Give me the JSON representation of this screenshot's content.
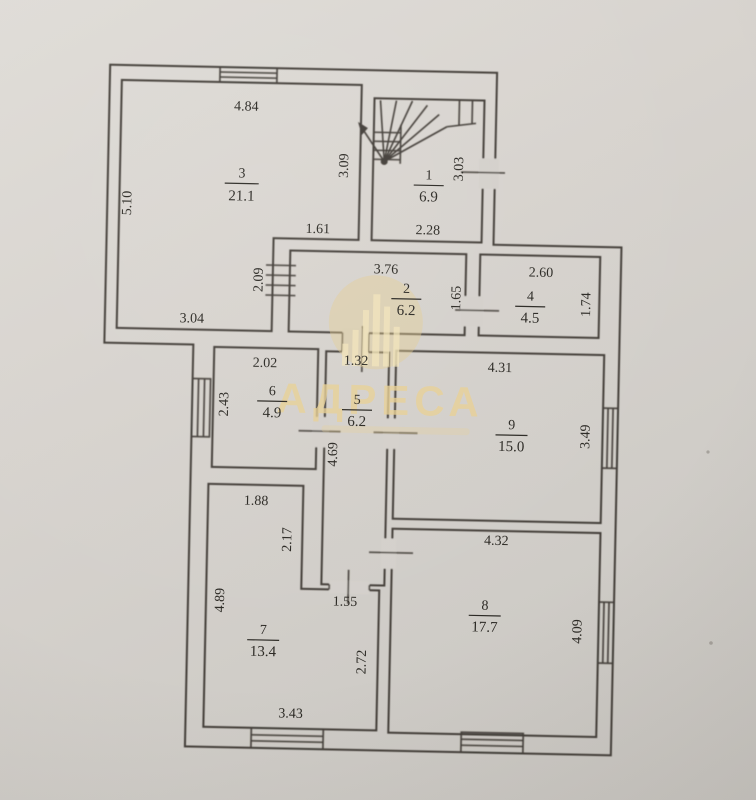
{
  "plan": {
    "watermark": {
      "brand": "АДРЕСА"
    },
    "rooms": {
      "r1": {
        "num": "1",
        "area": "6.9",
        "dims": {
          "bottom": "2.28",
          "right": "3.03"
        }
      },
      "r2": {
        "num": "2",
        "area": "6.2",
        "dims": {
          "top": "3.76"
        }
      },
      "r3": {
        "num": "3",
        "area": "21.1",
        "dims": {
          "top": "4.84",
          "left": "5.10",
          "right": "3.09",
          "notch_width": "1.61",
          "notch_height": "2.09",
          "bottom": "3.04"
        }
      },
      "r4": {
        "num": "4",
        "area": "4.5",
        "dims": {
          "top": "2.60",
          "right": "1.74",
          "door": "1.65"
        }
      },
      "r5": {
        "num": "5",
        "area": "6.2",
        "dims": {
          "top": "1.32",
          "left": "4.69",
          "door_bottom": "1.55"
        }
      },
      "r6": {
        "num": "6",
        "area": "4.9",
        "dims": {
          "top": "2.02",
          "left": "2.43"
        }
      },
      "r7": {
        "num": "7",
        "area": "13.4",
        "dims": {
          "top": "1.88",
          "notch": "2.17",
          "left": "4.89",
          "right": "2.72",
          "bottom": "3.43"
        }
      },
      "r8": {
        "num": "8",
        "area": "17.7",
        "dims": {
          "top": "4.32",
          "right": "4.09"
        }
      },
      "r9": {
        "num": "9",
        "area": "15.0",
        "dims": {
          "top": "4.31",
          "right": "3.49"
        }
      }
    },
    "colors": {
      "paper": "#d5d1cc",
      "ink": "#423e38",
      "watermark_gold": "#e8d094"
    }
  }
}
